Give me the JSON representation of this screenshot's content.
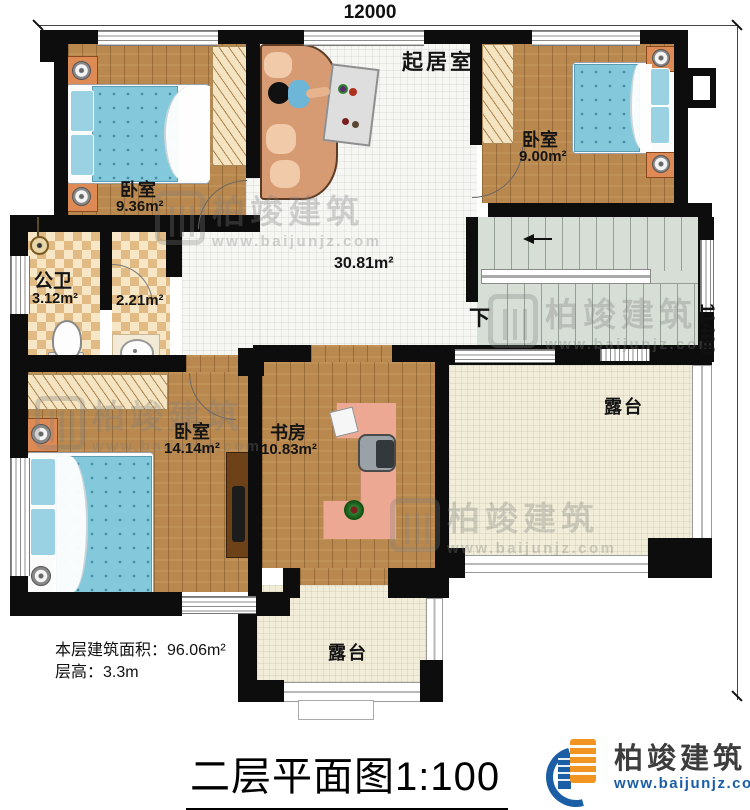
{
  "dimensions": {
    "top": "12000",
    "right": "11400"
  },
  "rooms": {
    "living": {
      "label": "起居室",
      "area": "30.81m²"
    },
    "bedroom1": {
      "label": "卧室",
      "area": "9.36m²"
    },
    "bedroom2": {
      "label": "卧室",
      "area": "9.00m²"
    },
    "bedroom3": {
      "label": "卧室",
      "area": "14.14m²"
    },
    "study": {
      "label": "书房",
      "area": "10.83m²"
    },
    "bath": {
      "label": "公卫",
      "area": "3.12m²"
    },
    "closet": {
      "area": "2.21m²"
    },
    "terrace_right": {
      "label": "露台"
    },
    "terrace_bottom": {
      "label": "露台"
    },
    "stairs": {
      "down_label": "下"
    }
  },
  "info": {
    "floor_area": "本层建筑面积：96.06m²",
    "floor_height": "层高：3.3m"
  },
  "title": {
    "text": "二层平面图",
    "scale": "1:100"
  },
  "watermark": {
    "text": "柏竣建筑",
    "url": "www.baijunjz.com"
  },
  "logo": {
    "name": "柏竣建筑",
    "url": "www.baijunjz.com"
  },
  "colors": {
    "wall": "#0d0d0d",
    "wood": "#b9884e",
    "mattress": "#84c8dc",
    "terrace": "#f1edd8",
    "stairs": "#d6ded6",
    "logo_blue": "#1b5ea6",
    "logo_orange": "#f29422"
  }
}
